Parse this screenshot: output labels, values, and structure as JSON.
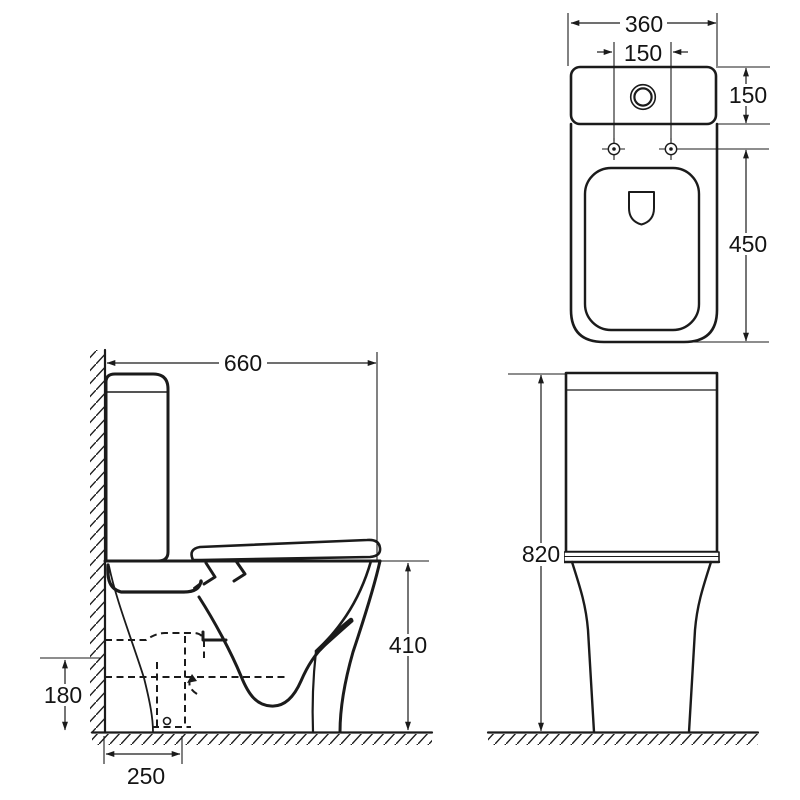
{
  "drawing": {
    "kind": "technical dimension drawing",
    "subject": "close-coupled toilet, three orthographic views",
    "background_color": "#ffffff",
    "line_color": "#1b1b1b"
  },
  "views": {
    "plan": {
      "label": "top view",
      "dimensions": {
        "overall_width": {
          "value": "360"
        },
        "hole_spacing": {
          "value": "150"
        },
        "cistern_depth": {
          "value": "150"
        },
        "pan_length": {
          "value": "450"
        }
      }
    },
    "side": {
      "label": "side view",
      "dimensions": {
        "overall_depth": {
          "value": "660"
        },
        "bowl_height": {
          "value": "410"
        },
        "outlet_height": {
          "value": "180"
        },
        "outlet_setout": {
          "value": "250"
        }
      }
    },
    "front": {
      "label": "front view",
      "dimensions": {
        "overall_height": {
          "value": "820"
        }
      }
    }
  }
}
